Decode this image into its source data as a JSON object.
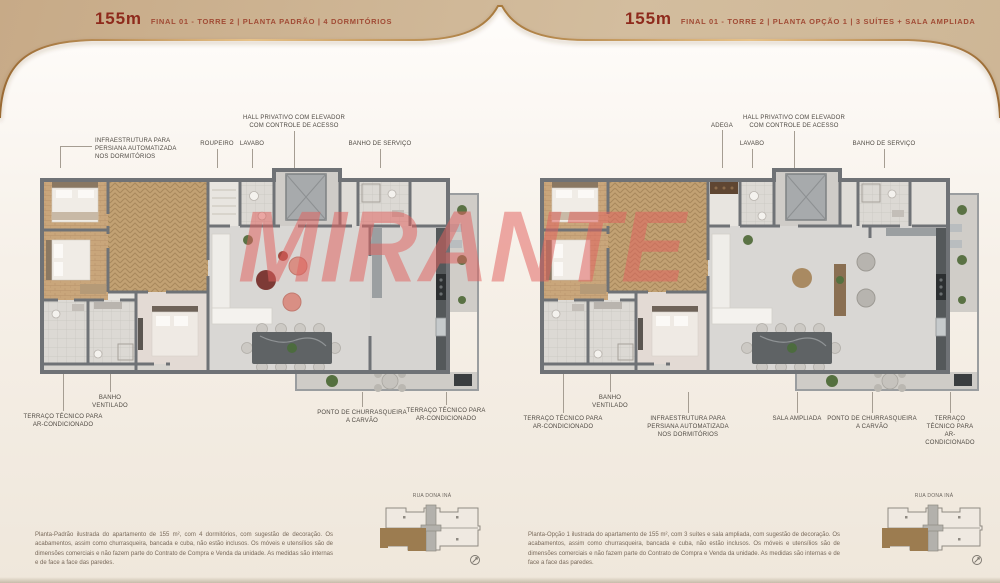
{
  "watermark": "MIRANTE",
  "panels": [
    {
      "header_area": "155m",
      "header_sub": "FINAL 01 - TORRE 2 | PLANTA PADRÃO | 4 DORMITÓRIOS",
      "labels": {
        "infra": "INFRAESTRUTURA PARA\nPERSIANA AUTOMATIZADA\nNOS DORMITÓRIOS",
        "roupeiro": "ROUPEIRO",
        "lavabo": "LAVABO",
        "hall": "HALL PRIVATIVO COM ELEVADOR\nCOM CONTROLE DE ACESSO",
        "banho_servico": "BANHO DE SERVIÇO",
        "banho_ventilado": "BANHO\nVENTILADO",
        "terraco_esq": "TERRAÇO TÉCNICO PARA\nAR-CONDICIONADO",
        "churrasqueira": "PONTO DE CHURRASQUEIRA\nA CARVÃO",
        "terraco_dir": "TERRAÇO TÉCNICO PARA\nAR-CONDICIONADO"
      },
      "disclaimer": "Planta-Padrão ilustrada do apartamento de 155 m², com 4 dormitórios, com sugestão de decoração. Os acabamentos, assim como churrasqueira, bancada e cuba, não estão inclusos. Os móveis e utensílios são de dimensões comerciais e não fazem parte do Contrato de Compra e Venda da unidade. As medidas são internas e de face a face das paredes.",
      "key_plan_street": "RUA DONA INÁ"
    },
    {
      "header_area": "155m",
      "header_sub": "FINAL 01 - TORRE 2 | PLANTA OPÇÃO 1 | 3 SUÍTES + SALA AMPLIADA",
      "labels": {
        "adega": "ADEGA",
        "lavabo": "LAVABO",
        "hall": "HALL PRIVATIVO COM ELEVADOR\nCOM CONTROLE DE ACESSO",
        "banho_servico": "BANHO DE SERVIÇO",
        "banho_ventilado": "BANHO\nVENTILADO",
        "terraco_esq": "TERRAÇO TÉCNICO PARA\nAR-CONDICIONADO",
        "infra": "INFRAESTRUTURA PARA\nPERSIANA AUTOMATIZADA\nNOS DORMITÓRIOS",
        "sala_ampliada": "SALA AMPLIADA",
        "churrasqueira": "PONTO DE CHURRASQUEIRA\nA CARVÃO",
        "terraco_dir": "TERRAÇO TÉCNICO PARA\nAR-CONDICIONADO"
      },
      "disclaimer": "Planta-Opção 1 ilustrada do apartamento de 155 m², com 3 suítes e sala ampliada, com sugestão de decoração. Os acabamentos, assim como churrasqueira, bancada e cuba, não estão inclusos. Os móveis e utensílios são de dimensões comerciais e não fazem parte do Contrato de Compra e Venda da unidade. As medidas são internas e de face a face das paredes.",
      "key_plan_street": "RUA DONA INÁ"
    }
  ],
  "colors": {
    "accent_red": "#8e2a1c",
    "header_text": "#a14b35",
    "watermark_pink": "#e2625f",
    "gold_line": "#c08a4d",
    "wall_gray": "#6f7276",
    "wood": "#c9a67b",
    "unit_brown": "#9c7c50"
  }
}
